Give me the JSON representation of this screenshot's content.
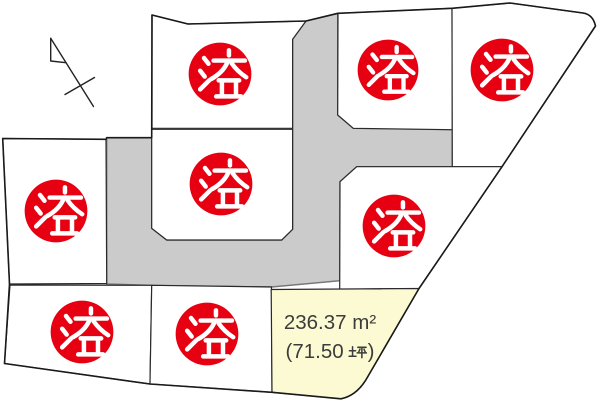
{
  "map": {
    "kind": "residential-lot-subdivision-map",
    "north_arrow": "north-arrow",
    "colors": {
      "road": "#cbcbcb",
      "lot_fill": "#ffffff",
      "available_fill": "#fbfad2",
      "stamp_red": "#e60012",
      "stamp_text": "#ffffff",
      "line": "#2a2a2a",
      "label_text": "#3c3c3c"
    },
    "sold_stamp": {
      "char": "済",
      "meaning": "sold",
      "count": 8
    },
    "lots": [
      {
        "id": "lot-top-center",
        "status": "sold",
        "stamp": "済"
      },
      {
        "id": "lot-top-right-inner",
        "status": "sold",
        "stamp": "済"
      },
      {
        "id": "lot-top-right-corner",
        "status": "sold",
        "stamp": "済"
      },
      {
        "id": "lot-west",
        "status": "sold",
        "stamp": "済"
      },
      {
        "id": "lot-center",
        "status": "sold",
        "stamp": "済"
      },
      {
        "id": "lot-east",
        "status": "sold",
        "stamp": "済"
      },
      {
        "id": "lot-south-west",
        "status": "sold",
        "stamp": "済"
      },
      {
        "id": "lot-south-center",
        "status": "sold",
        "stamp": "済"
      },
      {
        "id": "lot-available",
        "status": "available",
        "area_sqm": "236.37 ㎡",
        "area_tsubo": "(71.50 坪)"
      }
    ]
  },
  "available_label": {
    "sqm_value": "236.37",
    "sqm_unit": "m²",
    "tsubo_prefix": "(71.50",
    "tsubo_kanji": "坪",
    "tsubo_suffix": ")"
  }
}
